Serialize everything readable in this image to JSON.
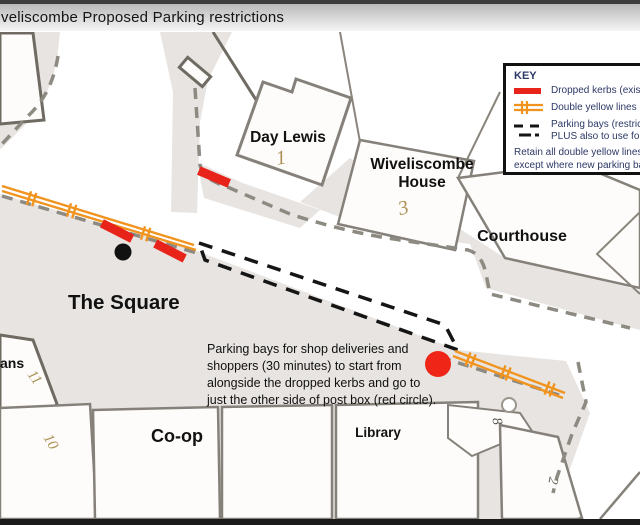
{
  "title": "veliscombe Proposed Parking restrictions",
  "legend": {
    "heading": "KEY",
    "item1_label": "Dropped kerbs (existing",
    "item2_label": "Double yellow lines PLU",
    "item3_label_line1": "Parking bays (restricted",
    "item3_label_line2": "PLUS also to use for sh",
    "note_line1": "Retain all double yellow lines a",
    "note_line2": "except where new parking bays"
  },
  "annotation": {
    "line1": "Parking bays for shop deliveries and",
    "line2": "shoppers (30 minutes) to start from",
    "line3": "alongside the dropped kerbs and go to",
    "line4": "just the other side of post box (red circle)."
  },
  "labels": {
    "day_lewis": "Day Lewis",
    "wiveliscombe_line1": "Wiveliscombe",
    "wiveliscombe_line2": "House",
    "courthouse": "Courthouse",
    "the_square": "The Square",
    "coop": "Co-op",
    "library": "Library",
    "ans": "ans"
  },
  "plot_numbers": {
    "day_lewis": "1",
    "wiveliscombe": "3",
    "ans_building": "11",
    "ten_building": "10",
    "eight_building": "8",
    "two_building": "2"
  },
  "colors": {
    "dropped_kerb_red": "#e8231a",
    "double_yellow_orange": "#f0941f",
    "road_gray": "#e7e4e1",
    "post_box_red": "#ee2517",
    "legend_text_navy": "#2d3966",
    "parking_bay_dash": "#151515"
  }
}
